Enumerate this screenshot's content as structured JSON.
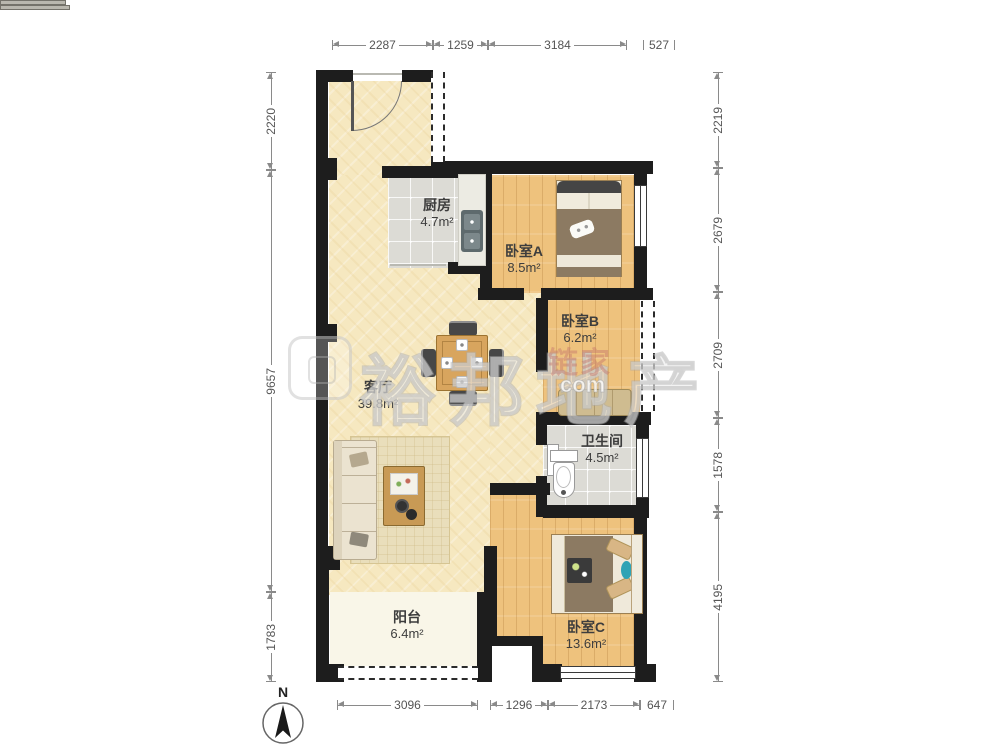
{
  "compass": {
    "label": "N"
  },
  "watermarks": {
    "brand_large": "裕邦地产",
    "brand_small": "链家",
    "brand_small_sub": "com"
  },
  "rooms": {
    "kitchen": {
      "name": "厨房",
      "area": "4.7m²"
    },
    "bedroom_a": {
      "name": "卧室A",
      "area": "8.5m²"
    },
    "bedroom_b": {
      "name": "卧室B",
      "area": "6.2m²"
    },
    "living": {
      "name": "客厅",
      "area": "39.8m²"
    },
    "bathroom": {
      "name": "卫生间",
      "area": "4.5m²"
    },
    "balcony": {
      "name": "阳台",
      "area": "6.4m²"
    },
    "bedroom_c": {
      "name": "卧室C",
      "area": "13.6m²"
    }
  },
  "dimensions": {
    "top": [
      "2287",
      "1259",
      "3184",
      "527"
    ],
    "left": [
      "2220",
      "9657",
      "1783"
    ],
    "right": [
      "2219",
      "2679",
      "2709",
      "1578",
      "4195"
    ],
    "bottom": [
      "3096",
      "1296",
      "2173",
      "647"
    ]
  },
  "colors": {
    "wall": "#1d1d1d",
    "wood_floor": "#eec27d",
    "living_floor": "#f6e8c0",
    "tile_floor": "#dcdbd5",
    "balcony_floor": "#f9f6e8"
  }
}
